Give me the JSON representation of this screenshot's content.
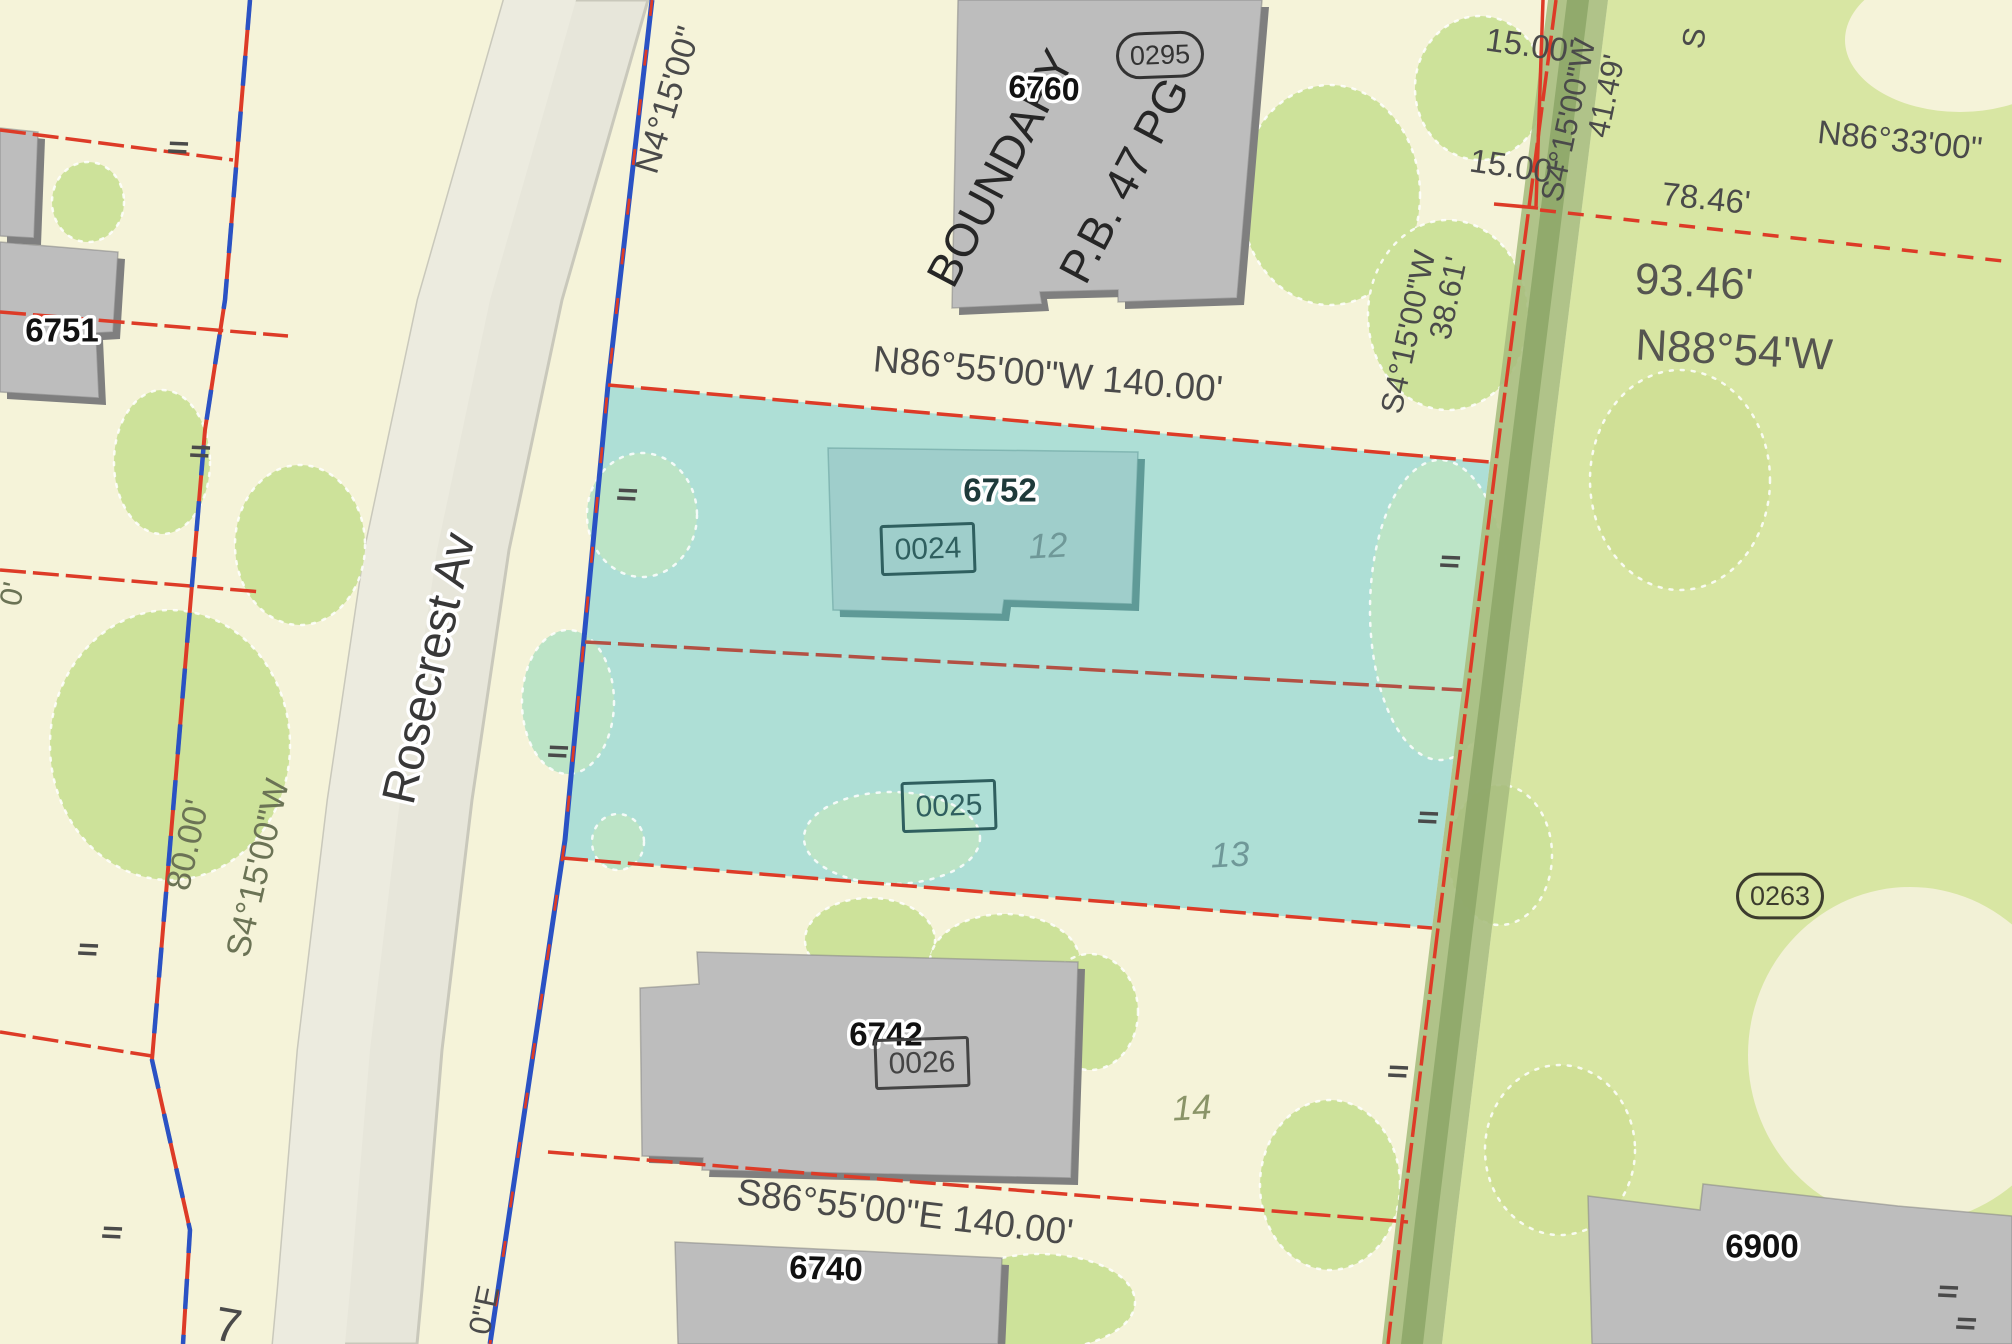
{
  "scene": {
    "canvas": {
      "width": 2012,
      "height": 1344,
      "background": "#f5f3d9"
    },
    "colors": {
      "cream": "#f5f3d9",
      "green": "#d8e6a3",
      "tree_cream": "#cde29a",
      "tree_green": "#d0e096",
      "cyan_parcel": "#aedfd6",
      "tree_cyan": "#bce4c6",
      "building": "#bdbdbd",
      "building_shadow": "#7f7f7f",
      "building_teal": "#9fcecb",
      "building_teal_shadow": "#5f9a97",
      "street": "#e7e6da",
      "street_stripe": "#ecebdf",
      "street_edge": "#c9c8bb",
      "alley": "#a8be80",
      "alley_stripe": "#8ca667",
      "line_red": "#dd3b27",
      "line_blue": "#2a52c4",
      "text_dark": "#4a4a4a",
      "text_olive": "#6b7355",
      "text_teal": "#2f5f5f",
      "lot_number_teal": "#6f9898",
      "lot_number_olive": "#8a9468"
    },
    "regions": [
      {
        "name": "green-parcel-east",
        "type": "polygon",
        "points": "1608,0 1554,430 1522,690 1492,928 1456,1222 1442,1344 2012,1344 2012,0",
        "fill": "#d8e6a3",
        "interactable": true
      },
      {
        "name": "clearing-top-right",
        "type": "ellipse",
        "cx": 1960,
        "cy": 40,
        "rx": 115,
        "ry": 72,
        "fill": "#f5f3d9",
        "interactable": false
      },
      {
        "name": "clearing-mid-right",
        "type": "ellipse",
        "cx": 1910,
        "cy": 1055,
        "rx": 162,
        "ry": 168,
        "fill": "#f2f1d6",
        "interactable": false
      }
    ],
    "street": {
      "band": "504,0 648,0 562,300 509,550 472,800 442,1050 422,1290 417,1344 273,1344 278,1290 298,1050 328,800 365,550 418,300",
      "stripe": "504,0 576,0 490,300 437,550 400,800 370,1050 350,1290 345,1344 273,1344 278,1290 298,1050 328,800 365,550 418,300"
    },
    "alley": {
      "band": "1548,0 1608,0 1554,430 1522,690 1492,928 1456,1222 1442,1344 1382,1344 1396,1222 1432,928 1462,690 1494,430",
      "stripe": "1567,0 1589,0 1535,430 1503,690 1473,928 1437,1222 1423,1344 1401,1344 1415,1222 1451,928 1481,690 1513,430"
    },
    "highlight_lots": [
      {
        "name": "lot-12-parcel",
        "points": "608,385 1490,462 1462,690 585,642",
        "fill": "#aedfd6",
        "interactable": true
      },
      {
        "name": "lot-13-parcel",
        "points": "585,642 1462,690 1432,928 562,858",
        "fill": "#aedfd6",
        "interactable": true
      }
    ],
    "trees": [
      {
        "x": 88,
        "y": 202,
        "rx": 36,
        "ry": 40,
        "fill": "#cde29a"
      },
      {
        "x": 162,
        "y": 462,
        "rx": 48,
        "ry": 72,
        "fill": "#cde29a"
      },
      {
        "x": 170,
        "y": 745,
        "rx": 120,
        "ry": 135,
        "fill": "#cde29a"
      },
      {
        "x": 300,
        "y": 545,
        "rx": 65,
        "ry": 80,
        "fill": "#cde29a"
      },
      {
        "x": 1330,
        "y": 195,
        "rx": 90,
        "ry": 110,
        "fill": "#cde29a"
      },
      {
        "x": 1480,
        "y": 88,
        "rx": 65,
        "ry": 72,
        "fill": "#cde29a"
      },
      {
        "x": 1448,
        "y": 315,
        "rx": 80,
        "ry": 95,
        "fill": "#cde29a"
      },
      {
        "x": 870,
        "y": 940,
        "rx": 65,
        "ry": 42,
        "fill": "#cde29a"
      },
      {
        "x": 1005,
        "y": 962,
        "rx": 75,
        "ry": 48,
        "fill": "#cde29a"
      },
      {
        "x": 1090,
        "y": 1012,
        "rx": 48,
        "ry": 58,
        "fill": "#cde29a"
      },
      {
        "x": 1040,
        "y": 1302,
        "rx": 95,
        "ry": 48,
        "fill": "#cde29a"
      },
      {
        "x": 1330,
        "y": 1185,
        "rx": 70,
        "ry": 85,
        "fill": "#cde29a"
      },
      {
        "x": 1680,
        "y": 480,
        "rx": 90,
        "ry": 110,
        "fill": "#d0e096"
      },
      {
        "x": 1560,
        "y": 1150,
        "rx": 75,
        "ry": 85,
        "fill": "#d0e096"
      },
      {
        "x": 642,
        "y": 515,
        "rx": 55,
        "ry": 62,
        "fill": "#bce4c6"
      },
      {
        "x": 568,
        "y": 702,
        "rx": 46,
        "ry": 72,
        "fill": "#bce4c6"
      },
      {
        "x": 618,
        "y": 842,
        "rx": 26,
        "ry": 28,
        "fill": "#bce4c6"
      },
      {
        "x": 892,
        "y": 838,
        "rx": 88,
        "ry": 46,
        "fill": "#bce4c6"
      },
      {
        "x": 1440,
        "y": 610,
        "rx": 70,
        "ry": 150,
        "fill": "#bce4c6"
      },
      {
        "x": 1500,
        "y": 855,
        "rx": 52,
        "ry": 70,
        "fill": "#cde29a"
      }
    ],
    "buildings": [
      {
        "name": "building-corner-nw",
        "points": "0,128 38,132 34,238 0,236",
        "fill": "#bdbdbd",
        "shadow": "#7f7f7f"
      },
      {
        "name": "building-6751",
        "points": "0,242 118,252 113,332 96,333 99,398 0,392",
        "fill": "#bdbdbd",
        "shadow": "#7f7f7f"
      },
      {
        "name": "building-6760",
        "points": "958,0 1262,0 1237,298 1118,302 1118,290 1040,292 1042,304 952,308",
        "fill": "#bdbdbd",
        "shadow": "#7f7f7f"
      },
      {
        "name": "building-6752",
        "points": "828,448 1138,452 1132,604 1004,600 1002,614 833,610",
        "fill": "#9fcecb",
        "shadow": "#5f9a97"
      },
      {
        "name": "building-6742",
        "points": "640,988 699,984 697,952 1078,962 1071,1178 702,1170 703,1158 642,1156",
        "fill": "#bdbdbd",
        "shadow": "#7f7f7f"
      },
      {
        "name": "building-6740",
        "points": "675,1242 1002,1258 998,1344 678,1344",
        "fill": "#bdbdbd",
        "shadow": "#7f7f7f"
      },
      {
        "name": "building-6900",
        "points": "1588,1196 1700,1210 1703,1184 1898,1206 2012,1216 2012,1344 1592,1344",
        "fill": "#bdbdbd",
        "shadow": "#7f7f7f"
      }
    ],
    "lines": [
      {
        "name": "property-line-nw-1",
        "points": "0,130 233,160",
        "stroke": "#dd3b27",
        "width": 3.5,
        "dash": "26 7"
      },
      {
        "name": "property-line-nw-2",
        "points": "0,312 288,336",
        "stroke": "#dd3b27",
        "width": 3.5,
        "dash": "26 7"
      },
      {
        "name": "property-line-nw-3",
        "points": "0,570 262,592",
        "stroke": "#dd3b27",
        "width": 3.5,
        "dash": "26 7"
      },
      {
        "name": "property-line-sw",
        "points": "0,1032 152,1056",
        "stroke": "#dd3b27",
        "width": 3.5,
        "dash": "26 7"
      },
      {
        "name": "west-boundary-red",
        "points": "250,0 225,300 205,430 152,1060 190,1230 183,1344",
        "stroke": "#dd3b27",
        "width": 4,
        "dash": ""
      },
      {
        "name": "west-boundary-blue",
        "points": "250,0 225,300 205,430 152,1060 190,1230 183,1344",
        "stroke": "#2a52c4",
        "width": 4.5,
        "dash": "30 26"
      },
      {
        "name": "frontage-boundary-blue",
        "points": "652,0 608,385 565,840 498,1290 490,1344",
        "stroke": "#2a52c4",
        "width": 5,
        "dash": ""
      },
      {
        "name": "frontage-boundary-red",
        "points": "652,0 608,385 565,840 498,1290 490,1344",
        "stroke": "#dd3b27",
        "width": 2.8,
        "dash": "16 34"
      },
      {
        "name": "lot12-north-line",
        "points": "608,385 1490,462",
        "stroke": "#dd3b27",
        "width": 3.5,
        "dash": "26 7"
      },
      {
        "name": "lot-divider-line",
        "points": "585,642 1462,690",
        "stroke": "#b35043",
        "width": 3.5,
        "dash": "26 7"
      },
      {
        "name": "lot13-south-line",
        "points": "562,858 1432,928",
        "stroke": "#dd3b27",
        "width": 3.5,
        "dash": "26 7"
      },
      {
        "name": "lot14-south-line",
        "points": "548,1152 1408,1222",
        "stroke": "#dd3b27",
        "width": 3.5,
        "dash": "26 7"
      },
      {
        "name": "alley-boundary-red",
        "points": "1556,0 1500,430 1468,690 1438,928 1402,1222 1388,1344",
        "stroke": "#dd3b27",
        "width": 3.5,
        "dash": "30 6"
      },
      {
        "name": "jog-vertical-red",
        "points": "1543,0 1536,206",
        "stroke": "#dd3b27",
        "width": 3.5,
        "dash": ""
      },
      {
        "name": "jog-horizontal-red",
        "points": "1494,204 1538,208",
        "stroke": "#dd3b27",
        "width": 3.5,
        "dash": ""
      },
      {
        "name": "dashed-boundary-east",
        "points": "1540,210 2012,262",
        "stroke": "#dd3b27",
        "width": 3.5,
        "dash": "16 12"
      }
    ],
    "ticks": [
      {
        "x": 178,
        "y": 148
      },
      {
        "x": 200,
        "y": 452
      },
      {
        "x": 627,
        "y": 495
      },
      {
        "x": 558,
        "y": 752
      },
      {
        "x": 1450,
        "y": 562
      },
      {
        "x": 1428,
        "y": 818
      },
      {
        "x": 1398,
        "y": 1072
      },
      {
        "x": 88,
        "y": 950
      },
      {
        "x": 112,
        "y": 1233
      },
      {
        "x": 1948,
        "y": 1292
      },
      {
        "x": 1966,
        "y": 1324
      }
    ],
    "labels": [
      {
        "name": "bearing-n4-15",
        "text": "N4°15'00\"",
        "x": 668,
        "y": 100,
        "rot": -73,
        "size": 34,
        "color": "#4a4a4a"
      },
      {
        "name": "boundary-text",
        "text": "BOUNDARY",
        "x": 1000,
        "y": 168,
        "rot": -62,
        "size": 46,
        "color": "#262626"
      },
      {
        "name": "plat-ref-text",
        "text": "P.B. 47 PG",
        "x": 1124,
        "y": 180,
        "rot": -62,
        "size": 46,
        "color": "#262626"
      },
      {
        "name": "parcel-6760-label",
        "text": "6760",
        "x": 1044,
        "y": 88,
        "rot": 3,
        "size": 32,
        "color": "#111111",
        "bold": true,
        "halo": true
      },
      {
        "name": "lot-id-0295",
        "text": "0295",
        "x": 1160,
        "y": 55,
        "rot": -2,
        "size": 27,
        "color": "#333333",
        "frame": "oval"
      },
      {
        "name": "dim-15-00-a",
        "text": "15.00'",
        "x": 1530,
        "y": 45,
        "rot": 8,
        "size": 33,
        "color": "#4a4a4a"
      },
      {
        "name": "dim-15-00-b",
        "text": "15.00'",
        "x": 1514,
        "y": 166,
        "rot": 8,
        "size": 33,
        "color": "#4a4a4a"
      },
      {
        "name": "bearing-s4-15-a",
        "text": "S4°15'00\"W",
        "x": 1568,
        "y": 120,
        "rot": -78,
        "size": 31,
        "color": "#4a4a4a"
      },
      {
        "name": "dim-41-49",
        "text": "41.49'",
        "x": 1606,
        "y": 96,
        "rot": -78,
        "size": 31,
        "color": "#4a4a4a"
      },
      {
        "name": "bearing-n86-33",
        "text": "N86°33'00\"",
        "x": 1900,
        "y": 140,
        "rot": 6,
        "size": 33,
        "color": "#4a4a4a"
      },
      {
        "name": "dim-78-46",
        "text": "78.46'",
        "x": 1706,
        "y": 198,
        "rot": 6,
        "size": 33,
        "color": "#4a4a4a"
      },
      {
        "name": "dim-93-46",
        "text": "93.46'",
        "x": 1694,
        "y": 282,
        "rot": 3,
        "size": 44,
        "color": "#555550"
      },
      {
        "name": "bearing-n88-54",
        "text": "N88°54'W",
        "x": 1734,
        "y": 350,
        "rot": 3,
        "size": 44,
        "color": "#555550"
      },
      {
        "name": "bearing-s4-15-b",
        "text": "S4°15'00\"W",
        "x": 1408,
        "y": 332,
        "rot": -78,
        "size": 31,
        "color": "#4a4a4a"
      },
      {
        "name": "dim-38-61",
        "text": "38.61'",
        "x": 1448,
        "y": 298,
        "rot": -78,
        "size": 31,
        "color": "#4a4a4a"
      },
      {
        "name": "bearing-n86-55",
        "text": "N86°55'00\"W 140.00'",
        "x": 1048,
        "y": 374,
        "rot": 5,
        "size": 37,
        "color": "#4a4a4a"
      },
      {
        "name": "parcel-6752-label",
        "text": "6752",
        "x": 1000,
        "y": 490,
        "rot": 0,
        "size": 33,
        "color": "#1e3a3a",
        "bold": true,
        "halo": true
      },
      {
        "name": "lot-id-0024",
        "text": "0024",
        "x": 928,
        "y": 549,
        "rot": -2,
        "size": 30,
        "color": "#2f5f5f",
        "frame": "box"
      },
      {
        "name": "lot-12-label",
        "text": "12",
        "x": 1048,
        "y": 546,
        "rot": -3,
        "size": 35,
        "color": "#6f9898",
        "italic": true
      },
      {
        "name": "lot-id-0025",
        "text": "0025",
        "x": 949,
        "y": 806,
        "rot": -2,
        "size": 30,
        "color": "#2f5f5f",
        "frame": "box"
      },
      {
        "name": "lot-13-label",
        "text": "13",
        "x": 1230,
        "y": 855,
        "rot": -3,
        "size": 35,
        "color": "#6f9898",
        "italic": true
      },
      {
        "name": "parcel-6742-label",
        "text": "6742",
        "x": 886,
        "y": 1034,
        "rot": 0,
        "size": 33,
        "color": "#111111",
        "bold": true,
        "halo": true
      },
      {
        "name": "lot-id-0026",
        "text": "0026",
        "x": 922,
        "y": 1063,
        "rot": -2,
        "size": 30,
        "color": "#444444",
        "frame": "box"
      },
      {
        "name": "lot-14-label",
        "text": "14",
        "x": 1192,
        "y": 1108,
        "rot": -3,
        "size": 35,
        "color": "#8a9468",
        "italic": true
      },
      {
        "name": "bearing-s86-55",
        "text": "S86°55'00\"E 140.00'",
        "x": 905,
        "y": 1212,
        "rot": 7,
        "size": 37,
        "color": "#4a4a4a"
      },
      {
        "name": "parcel-6740-label",
        "text": "6740",
        "x": 826,
        "y": 1268,
        "rot": 2,
        "size": 33,
        "color": "#111111",
        "bold": true,
        "halo": true
      },
      {
        "name": "parcel-6900-label",
        "text": "6900",
        "x": 1762,
        "y": 1246,
        "rot": 0,
        "size": 33,
        "color": "#111111",
        "bold": true,
        "halo": true
      },
      {
        "name": "lot-id-0263",
        "text": "0263",
        "x": 1780,
        "y": 896,
        "rot": 0,
        "size": 27,
        "color": "#3c3c2e",
        "frame": "oval"
      },
      {
        "name": "parcel-6751-label",
        "text": "6751",
        "x": 62,
        "y": 330,
        "rot": 0,
        "size": 33,
        "color": "#111111",
        "bold": true,
        "halo": true
      },
      {
        "name": "street-name-rosecrest",
        "text": "Rosecrest Av",
        "x": 428,
        "y": 668,
        "rot": -77,
        "size": 47,
        "color": "#383838",
        "halo": true
      },
      {
        "name": "dim-80-00",
        "text": "80.00'",
        "x": 188,
        "y": 845,
        "rot": -77,
        "size": 34,
        "color": "#6b7355"
      },
      {
        "name": "bearing-s4-15-west",
        "text": "S4°15'00\"W",
        "x": 258,
        "y": 868,
        "rot": -77,
        "size": 34,
        "color": "#6b7355"
      },
      {
        "name": "lot-7-label",
        "text": "7",
        "x": 228,
        "y": 1326,
        "rot": 10,
        "size": 48,
        "color": "#4a4a4a"
      },
      {
        "name": "bearing-frag-0e",
        "text": "0\"E",
        "x": 484,
        "y": 1310,
        "rot": -78,
        "size": 31,
        "color": "#4a4a4a"
      },
      {
        "name": "dim-frag-0",
        "text": "0'",
        "x": 12,
        "y": 594,
        "rot": -77,
        "size": 31,
        "color": "#6b7355"
      },
      {
        "name": "frag-s",
        "text": "S",
        "x": 1694,
        "y": 38,
        "rot": -80,
        "size": 31,
        "color": "#4a4a4a"
      }
    ]
  }
}
